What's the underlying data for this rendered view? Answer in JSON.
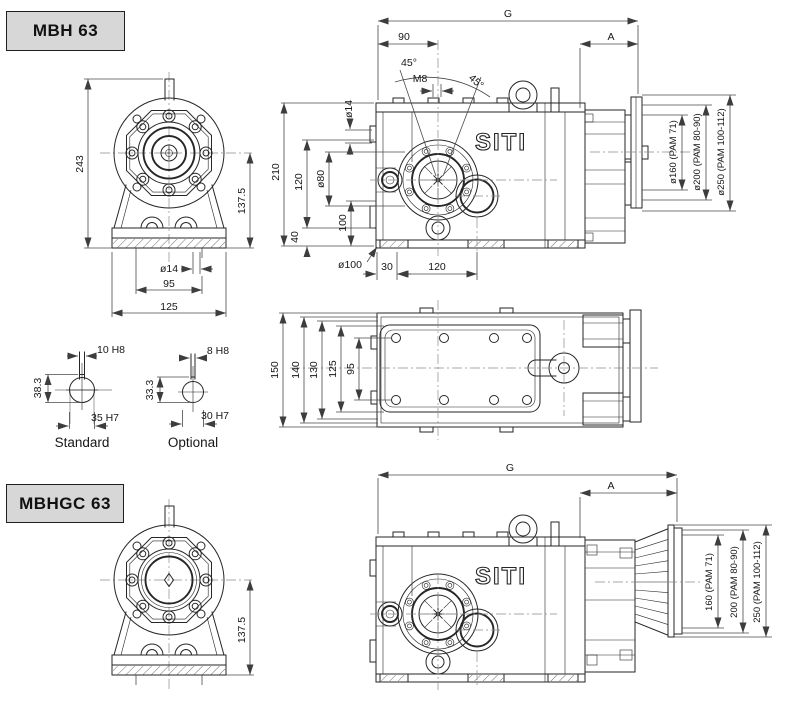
{
  "drawing": {
    "brand_logo": "SITI",
    "mbh": {
      "title": "MBH 63",
      "front": {
        "height_total": "243",
        "height_axis": "137.5",
        "foot_hole_dia": "ø14",
        "foot_hole_spacing": "95",
        "base_width": "125"
      },
      "side": {
        "overall_length": "G",
        "motor_section": "A",
        "input_offset": "90",
        "angle_left": "45°",
        "tap_size": "M8",
        "angle_right": "45°",
        "plug_dia": "ø14",
        "height_total": "210",
        "height_upper": "120",
        "input_flange_dia": "ø80",
        "height_mid": "100",
        "height_foot": "40",
        "boss_dia": "ø100",
        "foot_offset": "30",
        "foot_spacing": "120",
        "pam": [
          "ø160 (PAM 71)",
          "ø200 (PAM 80-90)",
          "ø250 (PAM 100-112)"
        ]
      }
    },
    "top_view": {
      "width_total": "150",
      "width_flange": "140",
      "width_body": "130",
      "width_face": "125",
      "hole_spacing": "95"
    },
    "bores": {
      "standard": {
        "keyway": "10 H8",
        "keyway_height": "38.3",
        "bore": "35 H7",
        "caption": "Standard"
      },
      "optional": {
        "keyway": "8 H8",
        "keyway_height": "33.3",
        "bore": "30 H7",
        "caption": "Optional"
      }
    },
    "mbhgc": {
      "title": "MBHGC 63",
      "front": {
        "height_axis": "137.5"
      },
      "side": {
        "overall_length": "G",
        "motor_section": "A",
        "pam": [
          "160 (PAM 71)",
          "200 (PAM 80-90)",
          "250 (PAM 100-112)"
        ]
      }
    }
  }
}
